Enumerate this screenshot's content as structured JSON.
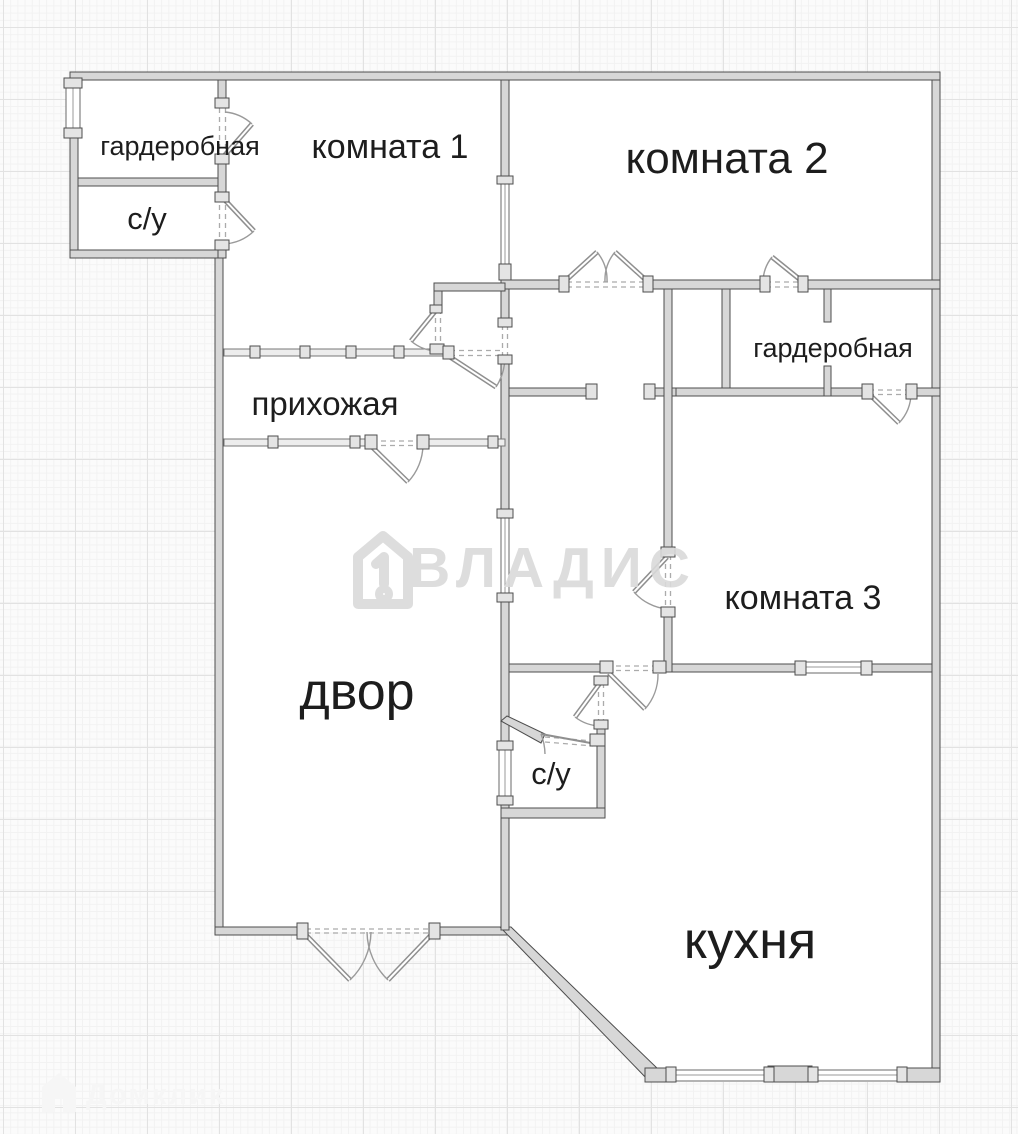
{
  "plan": {
    "rooms": [
      {
        "label": "гардеробная"
      },
      {
        "label": "комната 1"
      },
      {
        "label": "комната 2"
      },
      {
        "label": "с/у"
      },
      {
        "label": "прихожая"
      },
      {
        "label": "гардеробная"
      },
      {
        "label": "комната 3"
      },
      {
        "label": "двор"
      },
      {
        "label": "с/у"
      },
      {
        "label": "кухня"
      }
    ]
  },
  "watermarks": {
    "center": "ВЛАДИС",
    "bottom_left": "Домклик"
  },
  "colors": {
    "wall_fill": "#d7d7d7",
    "wall_stroke": "#4d4d4d",
    "label": "#1d1d1d",
    "door_arc": "#9a9a9a",
    "watermark_center": "#dadada",
    "watermark_corner": "#f6f6f6",
    "bg": "#fbfbfb"
  }
}
